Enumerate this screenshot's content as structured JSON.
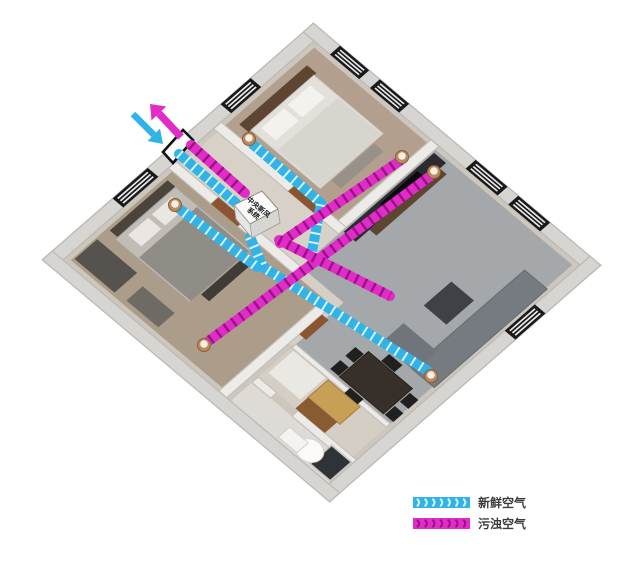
{
  "unit": {
    "name": "中央新风系统",
    "label_line1": "中央新风",
    "label_line2": "系统"
  },
  "legend": {
    "items": [
      {
        "id": "fresh",
        "label": "新鲜空气",
        "bar_color": "#2fb3e8",
        "tick_color": "#d9f4fd"
      },
      {
        "id": "exhaust",
        "label": "污浊空气",
        "bar_color": "#e22cc9",
        "tick_color": "#9a1286"
      }
    ]
  },
  "colors": {
    "fresh_duct": "#2fb3e8",
    "fresh_tick": "#d9f4fd",
    "exhaust_duct": "#e22cc9",
    "exhaust_tick": "#9a1286",
    "diffuser_ring": "#bd8a5f",
    "diffuser_face": "#f4efe8",
    "vent_frame": "#111111"
  },
  "ducts": [
    {
      "type": "fresh",
      "name": "fresh-intake-vent-to-unit",
      "points": [
        [
          179,
          154
        ],
        [
          236,
          203
        ]
      ]
    },
    {
      "type": "fresh",
      "name": "fresh-main-unit-to-dining",
      "points": [
        [
          250,
          237
        ],
        [
          263,
          267
        ],
        [
          428,
          371
        ]
      ]
    },
    {
      "type": "fresh",
      "name": "fresh-branch-top-bedroom",
      "points": [
        [
          250,
          142
        ],
        [
          321,
          203
        ],
        [
          311,
          257
        ]
      ]
    },
    {
      "type": "fresh",
      "name": "fresh-branch-left-bedroom",
      "points": [
        [
          177,
          207
        ],
        [
          257,
          267
        ]
      ]
    },
    {
      "type": "exhaust",
      "name": "exhaust-unit-to-vent",
      "points": [
        [
          191,
          145
        ],
        [
          245,
          193
        ]
      ]
    },
    {
      "type": "exhaust",
      "name": "exhaust-top-bedroom-to-unit",
      "points": [
        [
          401,
          160
        ],
        [
          280,
          243
        ]
      ]
    },
    {
      "type": "exhaust",
      "name": "exhaust-living-to-left-bedroom",
      "points": [
        [
          433,
          174
        ],
        [
          300,
          273
        ],
        [
          206,
          343
        ]
      ]
    },
    {
      "type": "exhaust",
      "name": "exhaust-unit-hall-run",
      "points": [
        [
          279,
          240
        ],
        [
          390,
          296
        ]
      ]
    }
  ],
  "diffusers": [
    {
      "x": 249,
      "y": 139,
      "type": "fresh"
    },
    {
      "x": 175,
      "y": 205,
      "type": "fresh"
    },
    {
      "x": 431,
      "y": 376,
      "type": "fresh"
    },
    {
      "x": 402,
      "y": 157,
      "type": "exhaust"
    },
    {
      "x": 434,
      "y": 172,
      "type": "exhaust"
    },
    {
      "x": 204,
      "y": 345,
      "type": "exhaust"
    }
  ],
  "arrows": {
    "fresh_in": {
      "from": [
        133,
        114
      ],
      "to": [
        163,
        144
      ],
      "color": "#2fb3e8",
      "width": 6.5
    },
    "exhaust_out": {
      "from": [
        181,
        137
      ],
      "to": [
        150,
        104
      ],
      "color": "#e22cc9",
      "width": 7.5
    }
  }
}
